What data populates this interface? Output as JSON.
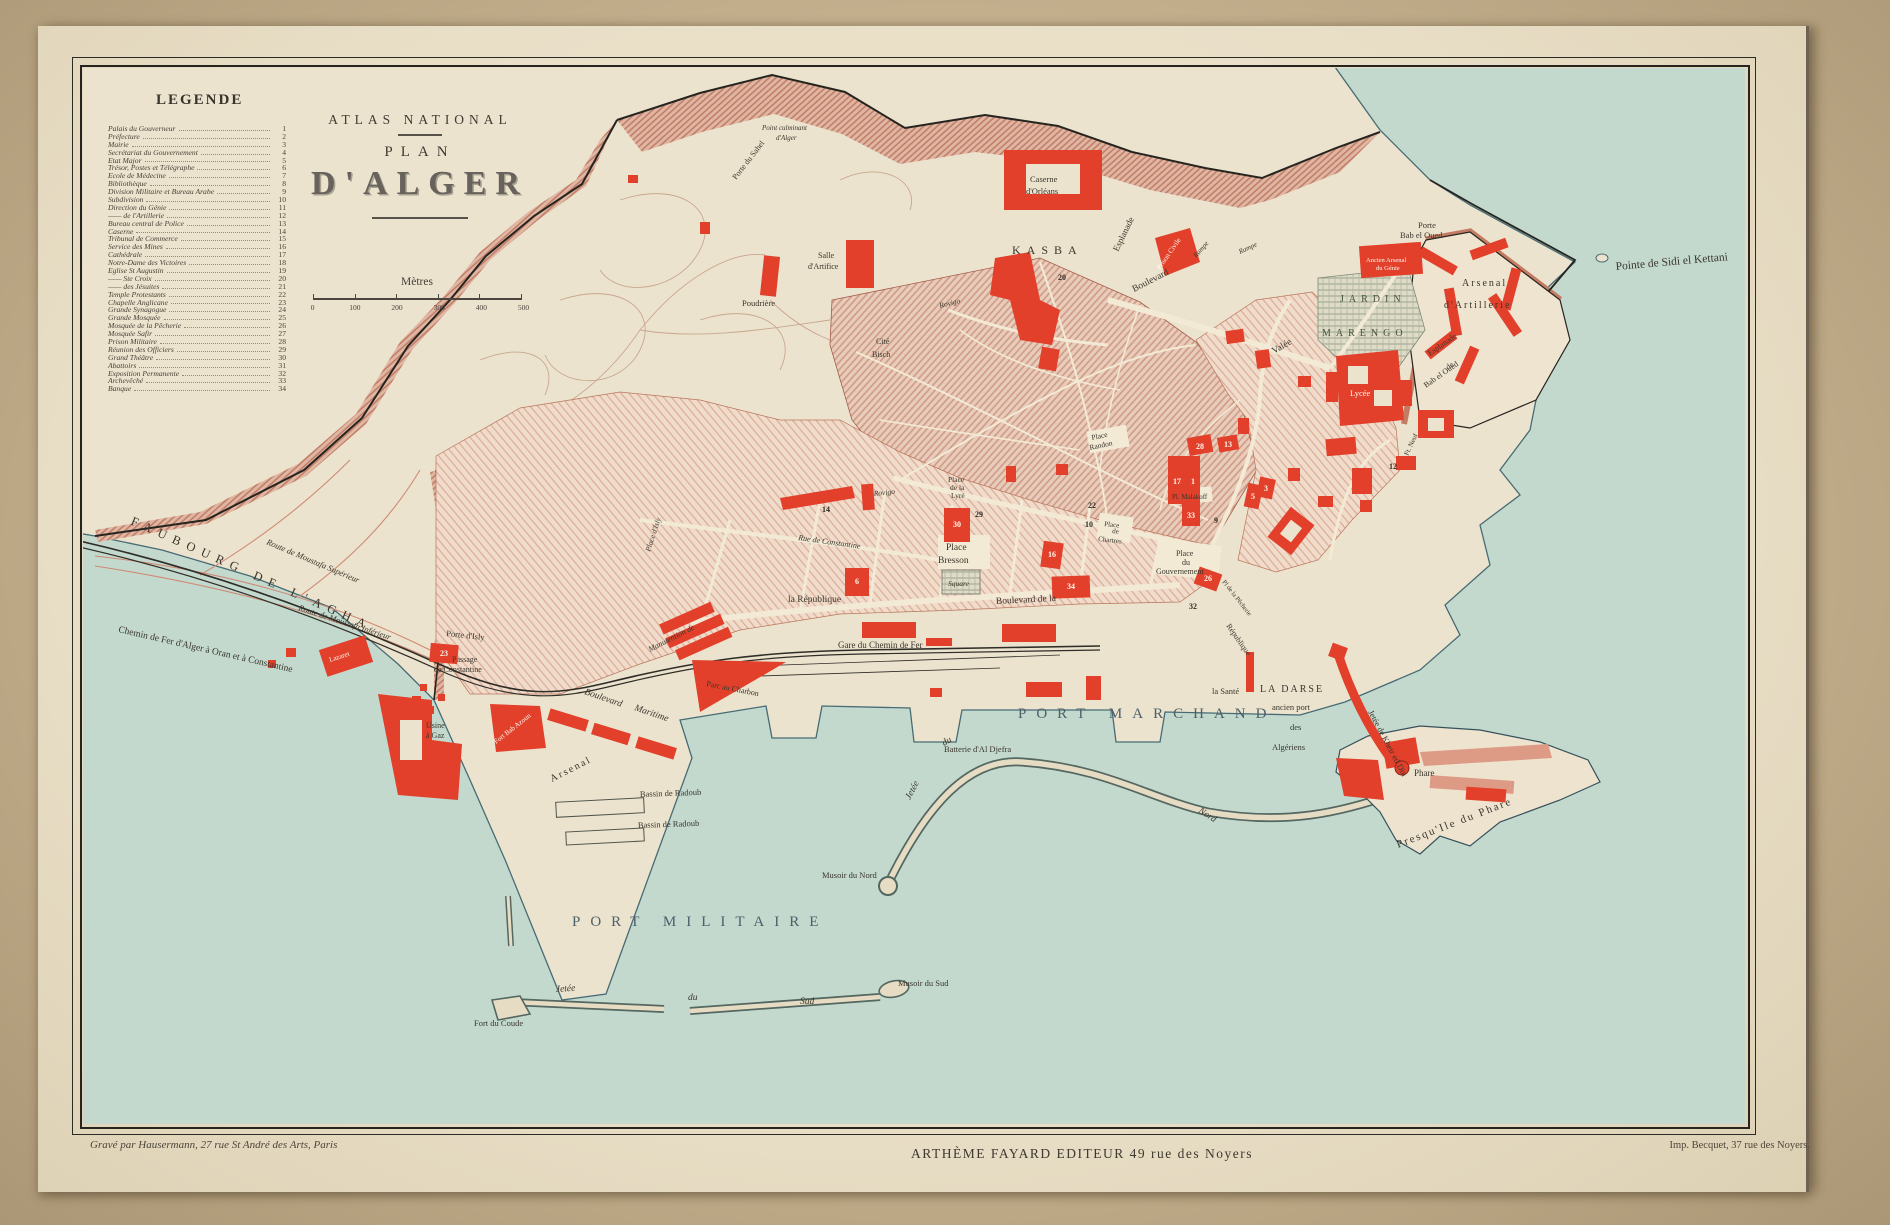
{
  "legend": {
    "title": "LEGENDE",
    "items": [
      {
        "label": "Palais du Gouverneur",
        "num": "1"
      },
      {
        "label": "Préfecture",
        "num": "2"
      },
      {
        "label": "Mairie",
        "num": "3"
      },
      {
        "label": "Secrétariat du Gouvernement",
        "num": "4"
      },
      {
        "label": "Etat Major",
        "num": "5"
      },
      {
        "label": "Trésor, Postes et Télégraphe",
        "num": "6"
      },
      {
        "label": "Ecole de Médecine",
        "num": "7"
      },
      {
        "label": "Bibliothèque",
        "num": "8"
      },
      {
        "label": "Division Militaire et Bureau Arabe",
        "num": "9"
      },
      {
        "label": "Subdivision",
        "num": "10"
      },
      {
        "label": "Direction du Génie",
        "num": "11"
      },
      {
        "label": "—— de l'Artillerie",
        "num": "12"
      },
      {
        "label": "Bureau central de Police",
        "num": "13"
      },
      {
        "label": "Caserne",
        "num": "14"
      },
      {
        "label": "Tribunal de Commerce",
        "num": "15"
      },
      {
        "label": "Service des Mines",
        "num": "16"
      },
      {
        "label": "Cathédrale",
        "num": "17"
      },
      {
        "label": "Notre-Dame des Victoires",
        "num": "18"
      },
      {
        "label": "Eglise St Augustin",
        "num": "19"
      },
      {
        "label": "—— Ste Croix",
        "num": "20"
      },
      {
        "label": "—— des Jésuites",
        "num": "21"
      },
      {
        "label": "Temple Protestants",
        "num": "22"
      },
      {
        "label": "Chapelle Anglicane",
        "num": "23"
      },
      {
        "label": "Grande Synagogue",
        "num": "24"
      },
      {
        "label": "Grande Mosquée",
        "num": "25"
      },
      {
        "label": "Mosquée de la Pêcherie",
        "num": "26"
      },
      {
        "label": "Mosquée Safir",
        "num": "27"
      },
      {
        "label": "Prison Militaire",
        "num": "28"
      },
      {
        "label": "Réunion des Officiers",
        "num": "29"
      },
      {
        "label": "Grand Théâtre",
        "num": "30"
      },
      {
        "label": "Abattoirs",
        "num": "31"
      },
      {
        "label": "Exposition Permanente",
        "num": "32"
      },
      {
        "label": "Archevêché",
        "num": "33"
      },
      {
        "label": "Banque",
        "num": "34"
      }
    ]
  },
  "title_block": {
    "line1": "ATLAS NATIONAL",
    "line2": "PLAN",
    "line3": "D'ALGER",
    "scale_label": "Mètres",
    "scale_ticks": [
      "0",
      "100",
      "200",
      "300",
      "400",
      "500"
    ]
  },
  "captions": {
    "engraver": "Gravé par Hausermann, 27 rue St André des Arts, Paris",
    "publisher": "ARTHÈME FAYARD EDITEUR 49 rue des Noyers",
    "printer": "Imp. Becquet, 37 rue des Noyers."
  },
  "colors": {
    "sea": "#c3d9ce",
    "building_red": "#e2402b",
    "rampart": "#c37b63",
    "paper": "#ebe2cc",
    "mat": "#c4b08d"
  },
  "map": {
    "labels": {
      "port_marchand": "PORT MARCHAND",
      "port_militaire": "PORT MILITAIRE",
      "faubourg": "FAUBOURG DE L'AGHA",
      "pointe": "Pointe de Sidi el Kettani",
      "presquile": "Presqu'Ile du Phare",
      "jetee_n1": "Jetée",
      "jetee_n2": "du",
      "jetee_n3": "Nord",
      "musoir_nord": "Musoir du Nord",
      "jetee_s1": "Jetée",
      "jetee_s2": "du",
      "jetee_s3": "Sud",
      "fort_coude": "Fort du Coude",
      "musoir_sud": "Musoir du Sud",
      "kheir": "Jetée de Kheir ed Din",
      "la_sante": "la Santé",
      "darse1": "LA DARSE",
      "darse2": "ancien port",
      "darse3": "des",
      "darse4": "Algériens",
      "phare": "Phare",
      "bassin1": "Bassin de Radoub",
      "bassin2": "Bassin de Radoub",
      "arsenal": "Arsenal",
      "bd_maritime1": "Boulevard",
      "bd_maritime2": "Maritime",
      "parc_charbon": "Parc au Charbon",
      "fort_bab_azoun": "Fort Bab Azoun",
      "usine1": "Usine",
      "usine2": "à Gaz",
      "lazaret": "Lazaret",
      "gare": "Gare du Chemin de Fer",
      "batterie": "Batterie d'Al Djefra",
      "chemin_fer": "Chemin de Fer d'Alger à Oran et à Constantine",
      "route_sup": "Route de Moustafa Supérieur",
      "route_inf": "Route de Moustafa Inférieur",
      "porte_isly": "Porte d'Isly",
      "passage1": "Passage",
      "passage2": "de Constantine",
      "manutention": "Manutention de",
      "pl_isly": "Place d'Isly",
      "rue_constantine": "Rue de Constantine",
      "la_republique": "la République",
      "bd_republique": "Boulevard de la",
      "rep_diag": "République",
      "pl_bresson1": "Place",
      "pl_bresson2": "Bresson",
      "square": "Square",
      "pl_lyre1": "Place",
      "pl_lyre2": "de la",
      "pl_lyre3": "Lyré",
      "chartres1": "Place",
      "chartres2": "de",
      "chartres3": "Chartres",
      "randon1": "Place",
      "randon2": "Randon",
      "malakoff": "Pl. Malakoff",
      "gouv1": "Place",
      "gouv2": "du",
      "gouv3": "Gouvernement",
      "pecherie": "Pl de la Pêcherie",
      "kasba": "KASBA",
      "caserne1": "Caserne",
      "caserne2": "d'Orléans",
      "esplanade_kasba": "Esplanade",
      "bd_valee1": "Boulevard",
      "bd_valee2": "Valée",
      "prison_civile": "Prison Civile",
      "rampe1": "Rampe",
      "rampe2": "Rampe",
      "porte_bo1": "Porte",
      "porte_bo2": "Bab el Oued",
      "ancien1": "Ancien Arsenal",
      "ancien2": "du Génie",
      "jardin1": "JARDIN",
      "jardin2": "MARENGO",
      "ars_art1": "Arsenal",
      "ars_art2": "d'Artillerie",
      "espl_bo1": "Esplanade",
      "espl_bo2": "de",
      "espl_bo3": "Bab el Oued",
      "ft_neuf": "Ft. Neuf",
      "culminant1": "Point culminant",
      "culminant2": "d'Alger",
      "porte_sahel": "Porte du Sahel",
      "poudriere": "Poudrière",
      "salle1": "Salle",
      "salle2": "d'Artifice",
      "cite1": "Cité",
      "cite2": "Bisch",
      "rovigo1": "Rovigo",
      "rovigo2": "Rovigo",
      "lycee": "Lycée"
    },
    "badges": {
      "b17": "17",
      "b1": "1",
      "b28": "28",
      "b13": "13",
      "b33": "33",
      "b9": "9",
      "b5": "5",
      "b3": "3",
      "b10": "10",
      "b22": "22",
      "b16": "16",
      "b30": "30",
      "b29": "29",
      "b6": "6",
      "b14": "14",
      "b23": "23",
      "b34": "34",
      "b32": "32",
      "b20": "20",
      "b12": "12",
      "b26": "26"
    }
  }
}
